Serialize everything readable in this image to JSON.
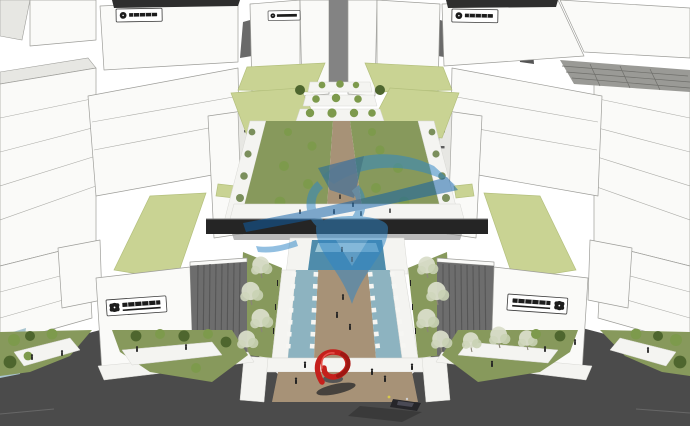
{
  "meta": {
    "type": "3d-architectural-rendering",
    "description": "Aerial SketchUp-style master-plan rendering: symmetric rows of white industrial buildings with light-green roofs flank a central landscaped pedestrian axis with twin blue water channels, white square planters, blossoming trees, a red spiral sculpture at the entry plaza, dark asphalt ring roads with tiny pedestrians and a car, and a translucent blue logo watermark over the center."
  },
  "palette": {
    "building_white": "#fafaf8",
    "building_shade": "#e7e7e3",
    "outline": "#9d9d99",
    "facade_dark": "#6d6d6d",
    "facade_stripe": "#565656",
    "roof_green": "#c9d393",
    "lawn": "#87995c",
    "lawn_dark": "#5d7637",
    "road": "#4b4b4b",
    "sidewalk": "#f4f4f1",
    "water_channel": "#8db3c0",
    "pool": "#4f8cab",
    "pool_light": "#bfe0ea",
    "path_tan": "#a79277",
    "bridge_dark": "#252525",
    "tree_blossom": "#d9ddc9",
    "tree_green": "#7d9a4c",
    "tree_dark": "#4e662e",
    "sculpture_red": "#c5201c",
    "sculpture_red_dark": "#9e1713",
    "people": "#232323",
    "sign_dark": "#1c1c1c",
    "watermark_blue": "#2f86c6",
    "watermark_deep": "#0f5fa8"
  },
  "watermark": {
    "name": "translucent-logo-watermark",
    "opacity": 0.5
  },
  "signs": {
    "rooftop": [
      {
        "position": "top-left-building"
      },
      {
        "position": "top-center-left-building"
      },
      {
        "position": "top-right-building"
      }
    ],
    "facade": [
      {
        "position": "front-left-building",
        "layout": "emblem-then-text"
      },
      {
        "position": "front-right-building",
        "layout": "text-then-emblem"
      }
    ],
    "note": "sign characters too small to be legible"
  },
  "scene": {
    "elements": [
      "white-buildings",
      "green-roofs",
      "central-axis",
      "terraced-planters",
      "water-channels",
      "planter-rows",
      "entry-plaza",
      "red-spiral-sculpture",
      "ring-road",
      "pedestrians",
      "car"
    ]
  }
}
